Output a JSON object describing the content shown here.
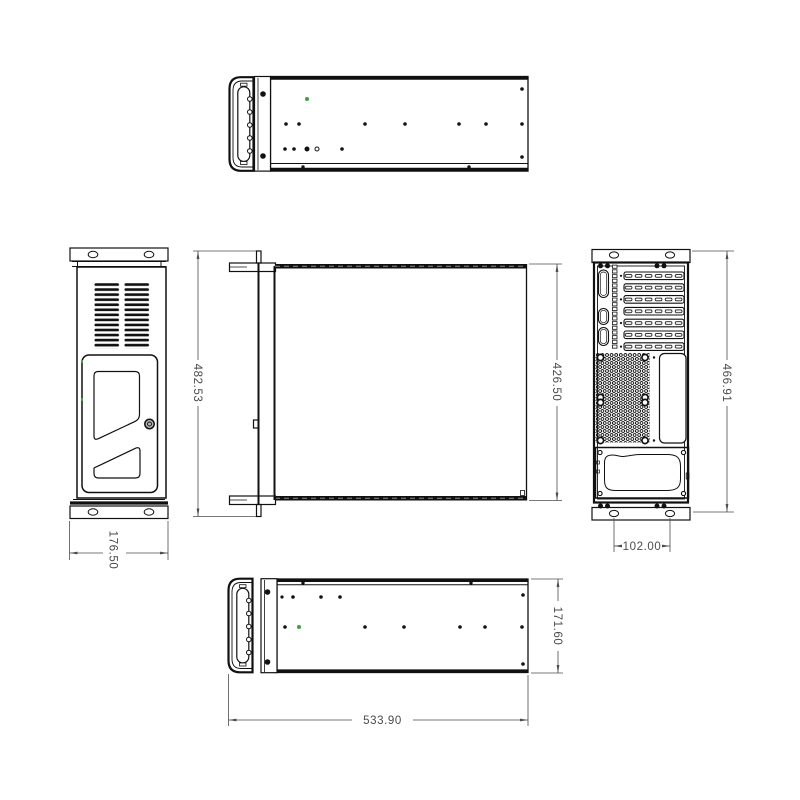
{
  "drawing": {
    "type": "technical-orthographic-drawing",
    "subject": "rackmount-chassis",
    "background": "#ffffff",
    "line_color": "#111111",
    "dimension_color": "#4a4a4a",
    "highlight_dot_color": "#3fa03f",
    "lock_fill": "#b5b5b5"
  },
  "dimensions": {
    "plan_overall_depth": "482.53",
    "plan_body_depth": "426.50",
    "front_width": "176.50",
    "rear_height": "466.91",
    "rear_hole_spacing": "102.00",
    "side_height": "171.60",
    "side_length": "533.90"
  }
}
